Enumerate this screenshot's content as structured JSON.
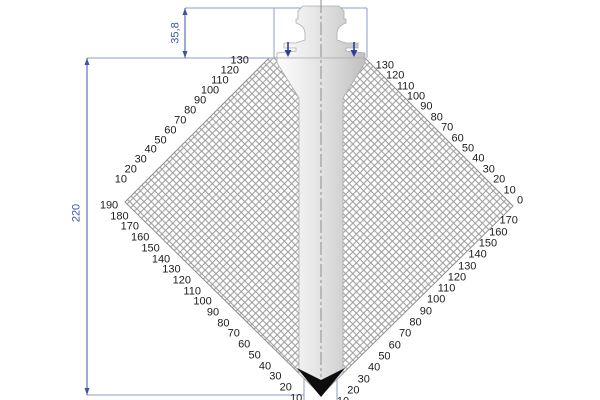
{
  "diagram_title": "press-brake-punch-collision-diagram",
  "dimensions": {
    "total_height": "220",
    "tang_height": "35,8"
  },
  "scales": {
    "upper_left": [
      "130",
      "120",
      "110",
      "100",
      "90",
      "80",
      "70",
      "60",
      "50",
      "40",
      "30",
      "20",
      "10"
    ],
    "upper_right": [
      "130",
      "120",
      "110",
      "100",
      "90",
      "80",
      "70",
      "60",
      "50",
      "40",
      "30",
      "20",
      "10",
      "0"
    ],
    "lower_left": [
      "190",
      "180",
      "170",
      "160",
      "150",
      "140",
      "130",
      "120",
      "110",
      "100",
      "90",
      "80",
      "70",
      "60",
      "50",
      "40",
      "30",
      "20",
      "10"
    ],
    "lower_right": [
      "170",
      "160",
      "150",
      "140",
      "130",
      "120",
      "110",
      "100",
      "90",
      "80",
      "70",
      "60",
      "50",
      "40",
      "30",
      "20",
      "10"
    ]
  },
  "colors": {
    "dimension_blue": "#3a55a8",
    "construction_blue": "#8d9cc8",
    "hatch_gray": "#9e9e9e",
    "edge_gray": "#8c8c8c",
    "tip_black": "#0d0d0d"
  }
}
